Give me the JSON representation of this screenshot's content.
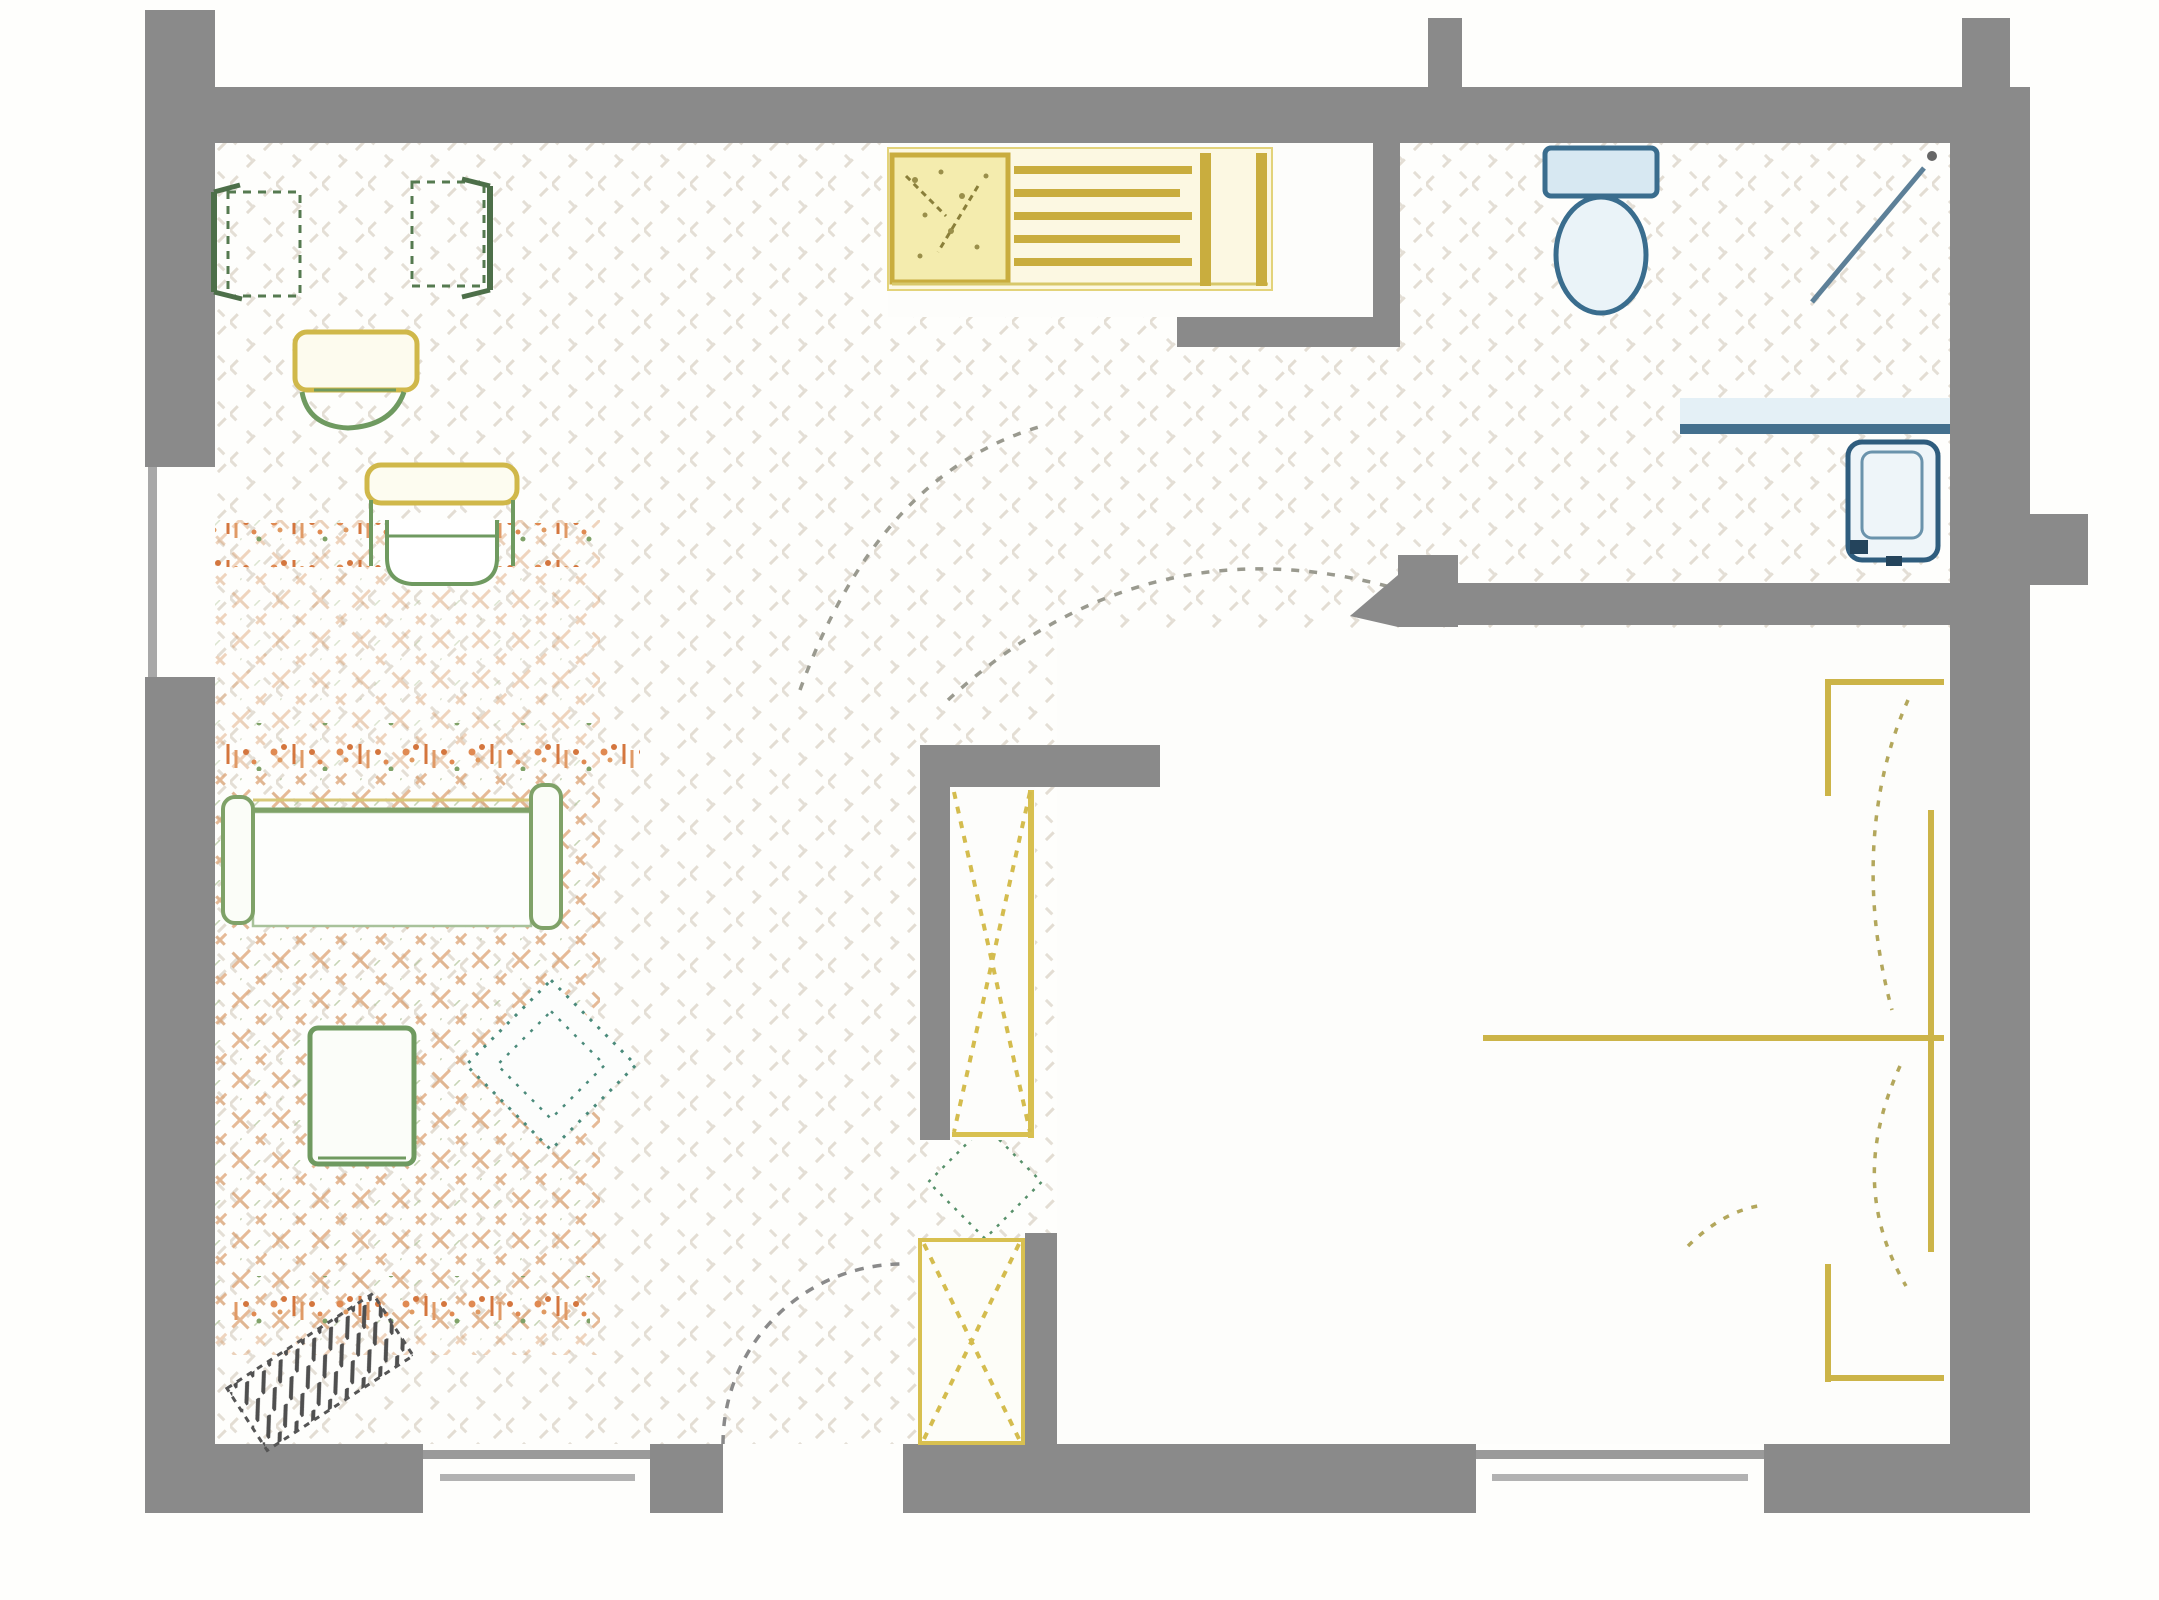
{
  "diagram": {
    "type": "floor-plan",
    "title": "",
    "palette": {
      "wall_gray": "#8a8a8a",
      "glass_gray": "#a8a8a8",
      "floor_hatch": "#dcd5c9",
      "kitchen_yellow": "#c9ad3e",
      "kitchen_fill": "#f4ecae",
      "bed_yellow": "#ccb448",
      "closet_yellow_dash": "#d4bc4e",
      "sofa_green": "#7fa268",
      "chair_dark_green": "#4d6f49",
      "table_green": "#6f9a60",
      "rug_orange": "#dca070",
      "flower_orange": "#dd8850",
      "teal_dotted": "#4a8a7a",
      "bath_blue": "#3a6d8e",
      "bath_light_blue": "#d7e8f2",
      "arc_dash_gray": "#9a9a8f",
      "mat_dark": "#4f4f4f"
    },
    "rooms": [
      {
        "id": "living-area"
      },
      {
        "id": "kitchen-nook"
      },
      {
        "id": "bathroom"
      },
      {
        "id": "bedroom"
      },
      {
        "id": "entry-vestibule"
      }
    ],
    "fixtures": [
      {
        "name": "dining-chair-left",
        "color": "chair_dark_green"
      },
      {
        "name": "dining-chair-right",
        "color": "chair_dark_green"
      },
      {
        "name": "side-table",
        "color": "kitchen_yellow"
      },
      {
        "name": "armchair",
        "color": "table_green"
      },
      {
        "name": "sofa",
        "color": "sofa_green"
      },
      {
        "name": "coffee-table",
        "color": "table_green"
      },
      {
        "name": "area-rug",
        "color": "rug_orange"
      },
      {
        "name": "living-diamond-rug",
        "color": "teal_dotted"
      },
      {
        "name": "kitchen-sink-unit",
        "color": "kitchen_yellow"
      },
      {
        "name": "cooktop-grill",
        "color": "kitchen_yellow"
      },
      {
        "name": "toilet",
        "color": "bath_blue"
      },
      {
        "name": "shower-door",
        "color": "bath_blue"
      },
      {
        "name": "vanity-sink",
        "color": "bath_blue"
      },
      {
        "name": "wardrobe-upper",
        "color": "closet_yellow_dash"
      },
      {
        "name": "wardrobe-lower",
        "color": "closet_yellow_dash"
      },
      {
        "name": "bed",
        "color": "bed_yellow"
      },
      {
        "name": "bedside-diamond-rug",
        "color": "teal_dotted"
      },
      {
        "name": "doormat",
        "color": "mat_dark"
      }
    ],
    "openings": {
      "windows": 3,
      "door_swing_arcs": 3,
      "entry_gap": 1
    }
  }
}
